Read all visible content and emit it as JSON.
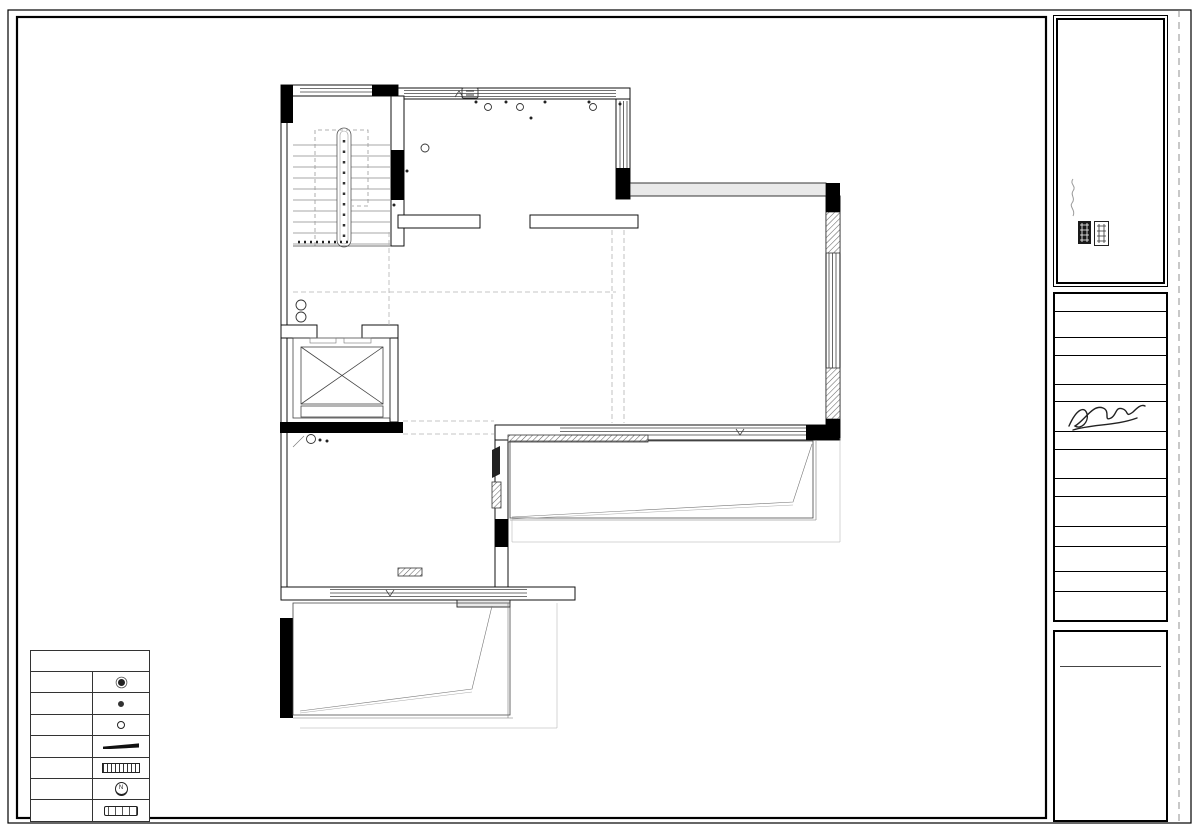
{
  "logo": {
    "brand_en": "Changhe",
    "brand_cn": "昌禾装饰",
    "slogan": [
      "造家",
      "造梦",
      "造生活"
    ]
  },
  "title_block": {
    "project_label": "工程名称",
    "project_label_en": "PROJECT:",
    "project_value_line1": "中房照悦湾冯总吉宅",
    "project_value_line2": "(69-101)",
    "drawing_label": "图纸名称",
    "drawing_label_en": "DRAWING TITLE:",
    "drawing_value": "3F原始结构图",
    "designer_label": "设计师/日期",
    "designer_label_en": "DESIGN/DATE:",
    "drafter_label": "制图员/日期",
    "drafter_label_en": "DRAWN/DATE:",
    "approver_label": "审核人/日期",
    "approver_label_en": "APPROVED/DATE:",
    "number_label": "图纸编号",
    "number_label_en": "DRAWING NO.:",
    "number_value": "AR-01",
    "scale_label": "比例",
    "scale_label_en": "SCALE:",
    "scale_value": "1: 50"
  },
  "company_block": {
    "address_line1": "宁夏银川市金凤区正源北街",
    "address_line2": "紫云华庭商业街",
    "company": "宁夏昌禾装饰工程有限公司",
    "phone": "电话/T：0951-5047688",
    "website": "网址/W：www.chzs.net",
    "note1_cn": "如有不符须立即通知设计人员",
    "note1_en": "CONTRACTORS MUST CHECK ALL DIMENSIONS ON SITE",
    "note2_cn": "施工时须以标注尺寸为准",
    "note2_en": "THIS DRAWING IS COPYRIGHT"
  },
  "footer": {
    "title_en": "ARCHITECTURAL PLAN",
    "title_cn": "3F原始结构图",
    "scale_note": "SCALE:1:50@A3"
  },
  "legend": {
    "title": "图例及说明",
    "rows": [
      {
        "label": "地漏"
      },
      {
        "label": "马桶"
      },
      {
        "label": "下水管"
      },
      {
        "label": "配电箱"
      },
      {
        "label": "多媒体箱"
      },
      {
        "label": "可视对讲机"
      },
      {
        "label": "分水器"
      }
    ]
  },
  "plan": {
    "room_labels": {
      "upper": "CH=3200",
      "main": "CH=3170"
    },
    "annotations": [
      {
        "line1": "JD:960",
        "line2": "CH:1700"
      },
      {
        "line1": "JD:660",
        "line2": "CH:1990"
      },
      {
        "line1": "LW:240",
        "line2": "LH:270"
      },
      {
        "line1": "LW:230",
        "line2": "LH:280"
      },
      {
        "line1": "JD:640",
        "line2": "CH:2040"
      },
      {
        "line1": "LW:230",
        "line2": "LH:480"
      },
      {
        "line1": "JD:330",
        "line2": "CH:2340"
      },
      {
        "line1": "JD:330",
        "line2": "CH:2340"
      }
    ],
    "dims": {
      "top": {
        "overall": "9790",
        "segments": [
          "1770",
          "3860",
          "3680"
        ]
      },
      "bottom": {
        "overall": "10020",
        "segments": [
          "3930",
          "2480",
          "3310"
        ]
      },
      "left": {
        "overall": "11180",
        "segments": [
          "4170",
          "1540",
          "2790",
          "1960"
        ]
      },
      "right": {
        "overall": "11180",
        "segments": [
          "1540",
          "4180",
          "2780",
          "1960"
        ]
      }
    }
  }
}
